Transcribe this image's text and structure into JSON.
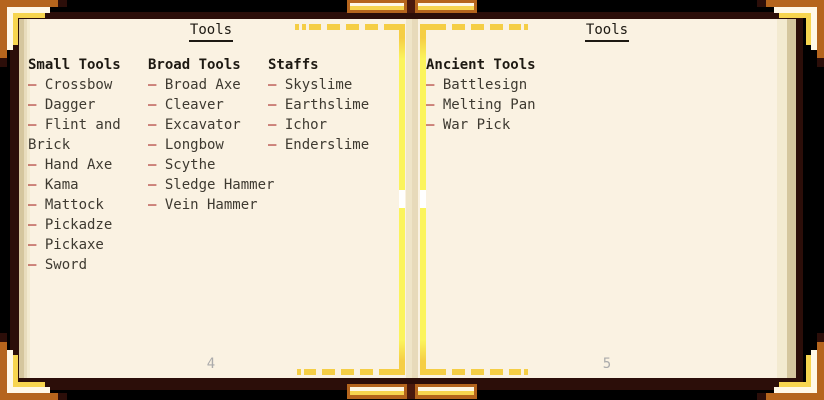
{
  "app": "encyclopedia-book",
  "list_bullet": "–",
  "left_page": {
    "title": "Tools",
    "page_number": "4",
    "columns": [
      {
        "heading": "Small Tools",
        "items": [
          "Crossbow",
          "Dagger",
          "Flint and Brick",
          "Hand Axe",
          "Kama",
          "Mattock",
          "Pickadze",
          "Pickaxe",
          "Sword"
        ]
      },
      {
        "heading": "Broad Tools",
        "items": [
          "Broad Axe",
          "Cleaver",
          "Excavator",
          "Longbow",
          "Scythe",
          "Sledge Hammer",
          "Vein Hammer"
        ]
      },
      {
        "heading": "Staffs",
        "items": [
          "Skyslime",
          "Earthslime",
          "Ichor",
          "Enderslime"
        ]
      }
    ]
  },
  "right_page": {
    "title": "Tools",
    "page_number": "5",
    "columns": [
      {
        "heading": "Ancient Tools",
        "items": [
          "Battlesign",
          "Melting Pan",
          "War Pick"
        ]
      }
    ]
  },
  "palette": {
    "background": "#000000",
    "cover_brown": "#2c0e09",
    "clasp_divider_brown": "#4a190d",
    "page_cream": "#faf2e2",
    "page_edge_light": "#f3ead0",
    "page_edge_mid": "#e8dcbd",
    "page_edge_dark": "#d5c69e",
    "spine_light": "#efe5c8",
    "spine_dark": "#e7daba",
    "ornament_orange": "#b5651d",
    "ornament_white": "#fff8e6",
    "ornament_yellow": "#f7d54f",
    "decor_gold": "#f5ce45",
    "decor_bright_yellow": "#fbf45c",
    "decor_gap_white": "#ffffff",
    "heading_text": "#1d1912",
    "body_text": "#3e3a31",
    "bullet_red": "#9e1212",
    "page_number_gray": "#ababab"
  }
}
